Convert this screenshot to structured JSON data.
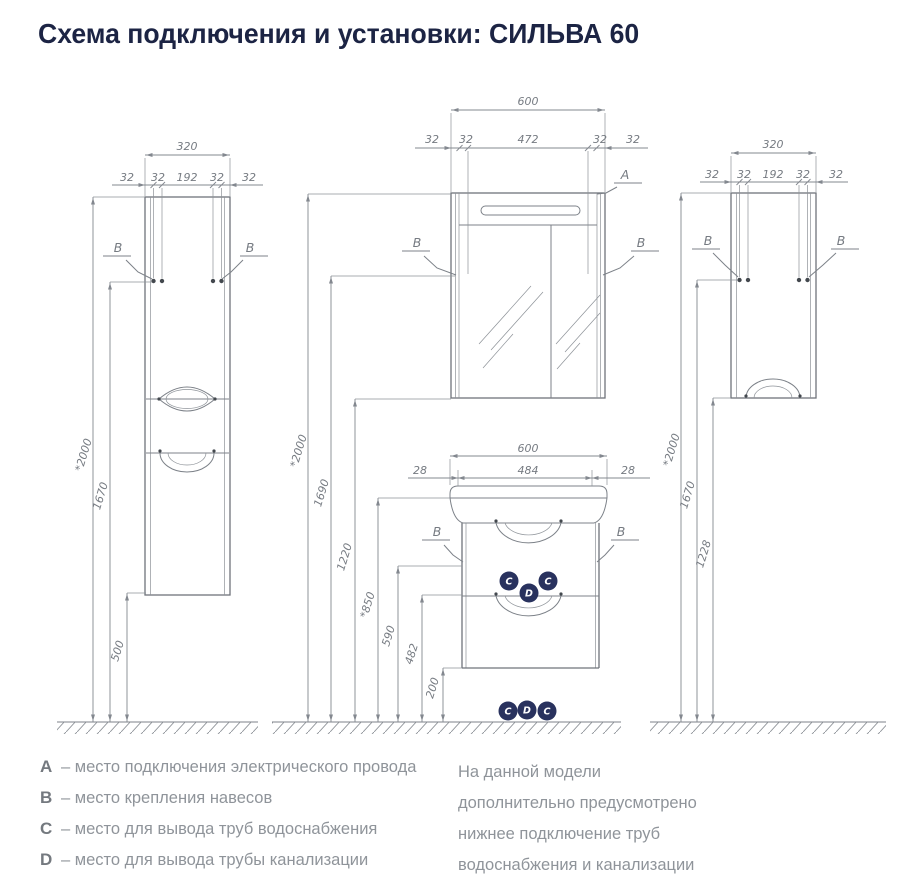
{
  "title": "Схема подключения и установки: СИЛЬВА 60",
  "drawing": {
    "left_cabinet": {
      "width": "320",
      "sub": [
        "32",
        "32",
        "192",
        "32",
        "32"
      ],
      "b": "B",
      "h_total": "*2000",
      "h_hang": "1670",
      "h_bottom": "500"
    },
    "mirror_cabinet": {
      "width": "600",
      "sub": [
        "32",
        "32",
        "472",
        "32",
        "32"
      ],
      "a": "A",
      "b": "B"
    },
    "vanity": {
      "width": "600",
      "sub": [
        "28",
        "484",
        "28"
      ],
      "b": "B",
      "badge_c": "C",
      "badge_d": "D"
    },
    "center_heights": {
      "total": "*2000",
      "mirror_hang": "1690",
      "mirror_bottom": "1220",
      "basin_top": "*850",
      "outlet_c": "590",
      "outlet_d": "482",
      "bottom": "200"
    },
    "right_cabinet": {
      "width": "320",
      "sub": [
        "32",
        "32",
        "192",
        "32",
        "32"
      ],
      "b": "B",
      "h_total": "*2000",
      "h_hang": "1670",
      "h_bottom": "1228"
    }
  },
  "legend": {
    "items": [
      {
        "key": "A",
        "text": "–  место подключения электрического провода"
      },
      {
        "key": "B",
        "text": "–  место крепления навесов"
      },
      {
        "key": "C",
        "text": "–  место для вывода труб водоснабжения"
      },
      {
        "key": "D",
        "text": "–  место для вывода трубы канализации"
      }
    ],
    "note_lines": [
      "На данной модели",
      "дополнительно предусмотрено",
      "нижнее подключение труб",
      "водоснабжения и канализации"
    ]
  },
  "colors": {
    "accent_navy": "#29325e",
    "title_navy": "#1c2444",
    "line_gray": "#7c8188",
    "text_gray": "#8f949a"
  }
}
